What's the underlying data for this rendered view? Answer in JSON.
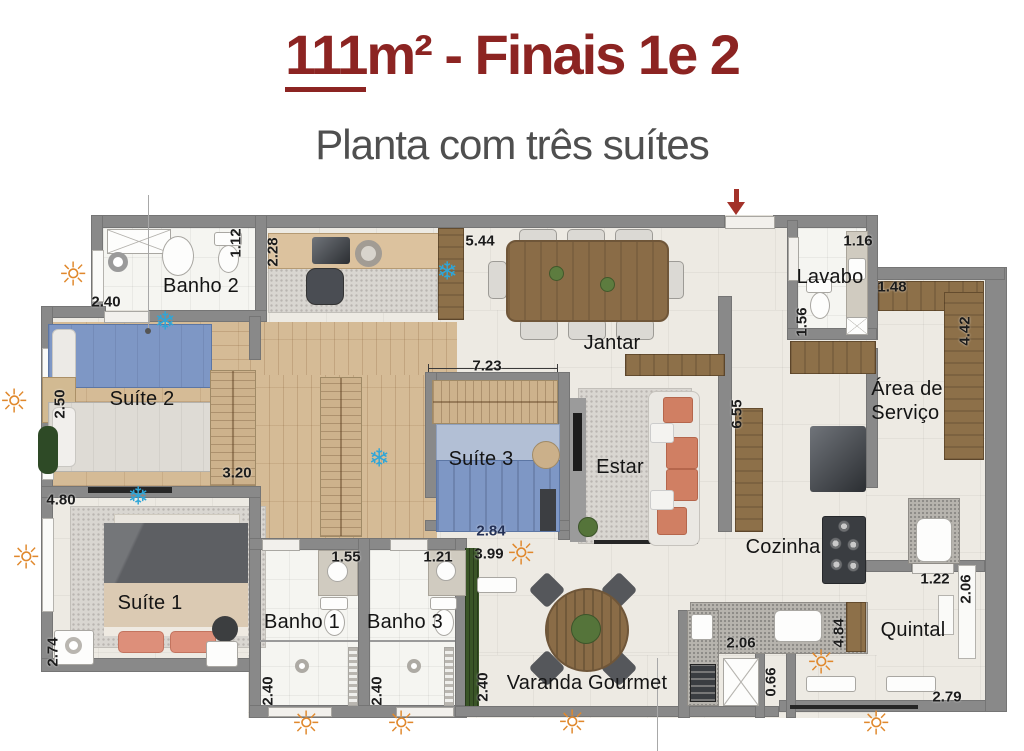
{
  "header": {
    "title_prefix": "111",
    "title_suffix": "m² - Finais 1e 2",
    "subtitle": "Planta com três suítes"
  },
  "colors": {
    "title": "#8c2422",
    "subtitle": "#4f4f4f",
    "wall": "#898989",
    "sun": "#e0882c",
    "snowflake": "#2fa6d8",
    "arrow": "#a3322a"
  },
  "rooms": [
    {
      "id": "banho-2",
      "label": "Banho 2",
      "x": 201,
      "y": 286
    },
    {
      "id": "suite-2",
      "label": "Suíte 2",
      "x": 142,
      "y": 399
    },
    {
      "id": "suite-1",
      "label": "Suíte 1",
      "x": 150,
      "y": 603
    },
    {
      "id": "banho-1",
      "label": "Banho 1",
      "x": 302,
      "y": 622
    },
    {
      "id": "banho-3",
      "label": "Banho 3",
      "x": 405,
      "y": 622
    },
    {
      "id": "suite-3",
      "label": "Suíte 3",
      "x": 481,
      "y": 459
    },
    {
      "id": "jantar",
      "label": "Jantar",
      "x": 612,
      "y": 343
    },
    {
      "id": "estar",
      "label": "Estar",
      "x": 620,
      "y": 467
    },
    {
      "id": "lavabo",
      "label": "Lavabo",
      "x": 830,
      "y": 277
    },
    {
      "id": "area-de-servico",
      "label": "Área de\nServiço",
      "x": 907,
      "y": 401
    },
    {
      "id": "cozinha",
      "label": "Cozinha",
      "x": 783,
      "y": 547
    },
    {
      "id": "quintal",
      "label": "Quintal",
      "x": 913,
      "y": 630
    },
    {
      "id": "varanda-gourmet",
      "label": "Varanda Gourmet",
      "x": 587,
      "y": 683
    }
  ],
  "dimensions": [
    {
      "value": "2.40",
      "x": 106,
      "y": 302
    },
    {
      "value": "1.12",
      "x": 236,
      "y": 243,
      "vertical": true
    },
    {
      "value": "2.28",
      "x": 273,
      "y": 252,
      "vertical": true
    },
    {
      "value": "5.44",
      "x": 480,
      "y": 241
    },
    {
      "value": "1.16",
      "x": 858,
      "y": 241
    },
    {
      "value": "1.48",
      "x": 892,
      "y": 287
    },
    {
      "value": "1.56",
      "x": 802,
      "y": 322,
      "vertical": true
    },
    {
      "value": "4.42",
      "x": 965,
      "y": 331,
      "vertical": true
    },
    {
      "value": "2.50",
      "x": 60,
      "y": 404,
      "vertical": true
    },
    {
      "value": "3.20",
      "x": 237,
      "y": 473
    },
    {
      "value": "4.80",
      "x": 61,
      "y": 500
    },
    {
      "value": "7.23",
      "x": 487,
      "y": 366
    },
    {
      "value": "6.55",
      "x": 737,
      "y": 414,
      "vertical": true
    },
    {
      "value": "2.84",
      "x": 491,
      "y": 531,
      "color": "#233055"
    },
    {
      "value": "3.99",
      "x": 489,
      "y": 554
    },
    {
      "value": "1.55",
      "x": 346,
      "y": 557
    },
    {
      "value": "1.21",
      "x": 438,
      "y": 557
    },
    {
      "value": "2.74",
      "x": 53,
      "y": 652,
      "vertical": true
    },
    {
      "value": "2.40",
      "x": 268,
      "y": 691,
      "vertical": true
    },
    {
      "value": "2.40",
      "x": 377,
      "y": 691,
      "vertical": true
    },
    {
      "value": "2.40",
      "x": 483,
      "y": 687,
      "vertical": true
    },
    {
      "value": "2.06",
      "x": 741,
      "y": 643
    },
    {
      "value": "4.84",
      "x": 839,
      "y": 633,
      "vertical": true
    },
    {
      "value": "1.22",
      "x": 935,
      "y": 579
    },
    {
      "value": "2.06",
      "x": 966,
      "y": 589,
      "vertical": true
    },
    {
      "value": "0.66",
      "x": 771,
      "y": 682,
      "vertical": true
    },
    {
      "value": "2.79",
      "x": 947,
      "y": 697
    }
  ],
  "icons": {
    "sun_glyph": "☼",
    "snowflake_glyph": "❄",
    "suns": [
      {
        "x": 73,
        "y": 274
      },
      {
        "x": 14,
        "y": 401
      },
      {
        "x": 26,
        "y": 557
      },
      {
        "x": 306,
        "y": 723
      },
      {
        "x": 401,
        "y": 723
      },
      {
        "x": 521,
        "y": 553
      },
      {
        "x": 572,
        "y": 722
      },
      {
        "x": 821,
        "y": 662
      },
      {
        "x": 876,
        "y": 723
      }
    ],
    "snowflakes": [
      {
        "x": 447,
        "y": 271
      },
      {
        "x": 165,
        "y": 321
      },
      {
        "x": 379,
        "y": 458
      },
      {
        "x": 138,
        "y": 496
      }
    ]
  }
}
